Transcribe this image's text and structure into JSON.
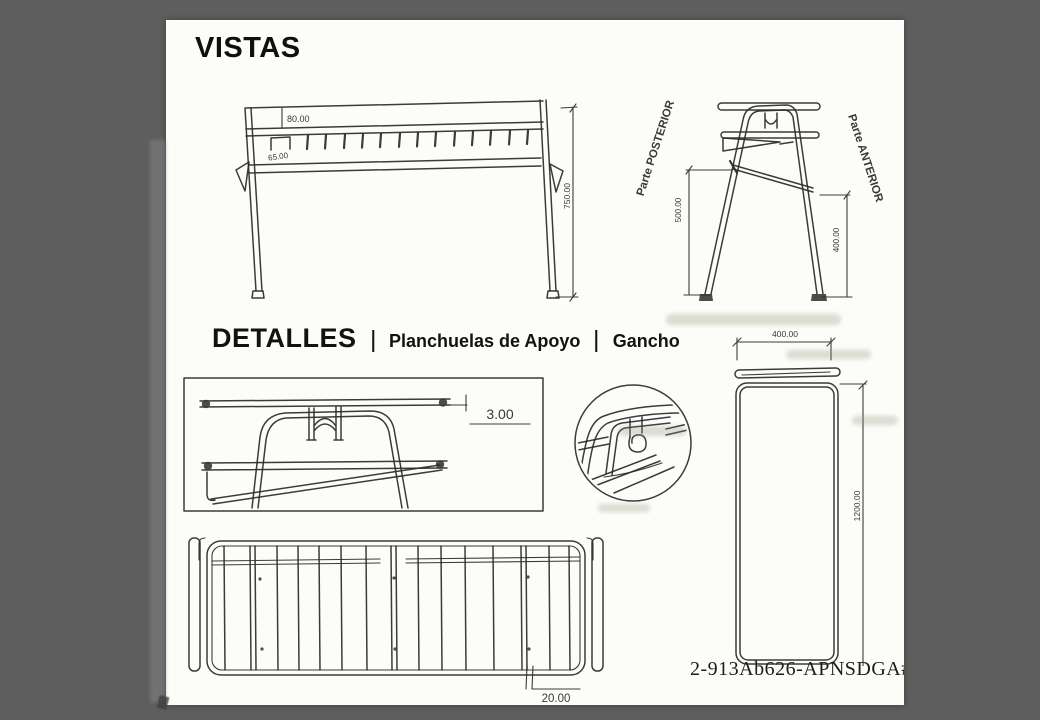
{
  "vistas": {
    "title": "VISTAS"
  },
  "front_view": {
    "dim_rail_width": "80.00",
    "dim_hook": "65.00",
    "dim_height": "750.00"
  },
  "side_view": {
    "label_rear": "Parte POSTERIOR",
    "label_front": "Parte ANTERIOR",
    "dim_rear_height": "500.00",
    "dim_front_height": "400.00"
  },
  "detalles": {
    "title": "DETALLES",
    "separator": "|",
    "item_plates": "Planchuelas de Apoyo",
    "item_hook": "Gancho"
  },
  "plate_detail": {
    "dim_thickness": "3.00"
  },
  "frame_view": {
    "dim_width": "400.00",
    "dim_height": "1200.00"
  },
  "grid_panel": {
    "dim_gap": "20.00"
  },
  "footer": {
    "drawing_code": "2-913Ab626-APNSDGA#N"
  }
}
